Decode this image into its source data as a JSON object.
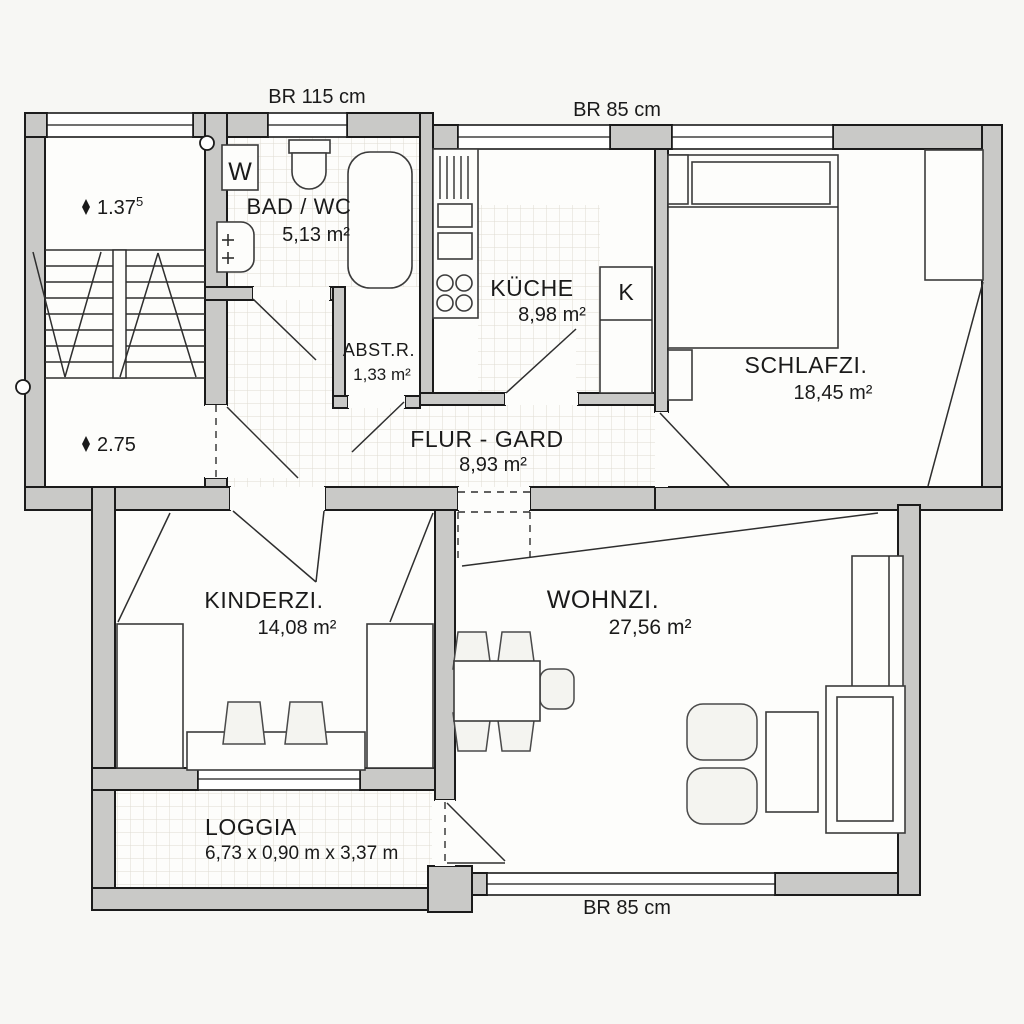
{
  "plan": {
    "type": "apartment-floor-plan",
    "background": "#f7f7f4",
    "wall_fill": "#c9c9c7",
    "line_color": "#1b1b1b"
  },
  "dimension_labels": {
    "br115": "BR 115 cm",
    "br85_top": "BR 85 cm",
    "br85_bottom": "BR 85 cm"
  },
  "levels": {
    "upper": {
      "value": "1.37",
      "sup": "5"
    },
    "lower": {
      "value": "2.75"
    }
  },
  "rooms": {
    "bad_wc": {
      "name": "BAD / WC",
      "area": "5,13 m²"
    },
    "abstellraum": {
      "name": "ABST.R.",
      "area": "1,33 m²"
    },
    "kueche": {
      "name": "KÜCHE",
      "area": "8,98 m²"
    },
    "schlafzimmer": {
      "name": "SCHLAFZI.",
      "area": "18,45 m²"
    },
    "flur": {
      "name": "FLUR - GARD",
      "area": "8,93 m²"
    },
    "kinderzimmer": {
      "name": "KINDERZI.",
      "area": "14,08 m²"
    },
    "wohnzimmer": {
      "name": "WOHNZI.",
      "area": "27,56 m²"
    },
    "loggia": {
      "name": "LOGGIA",
      "dimensions": "6,73 x 0,90 m x 3,37 m"
    }
  },
  "appliances": {
    "washing_machine": "W",
    "kitchen_column": "K"
  }
}
